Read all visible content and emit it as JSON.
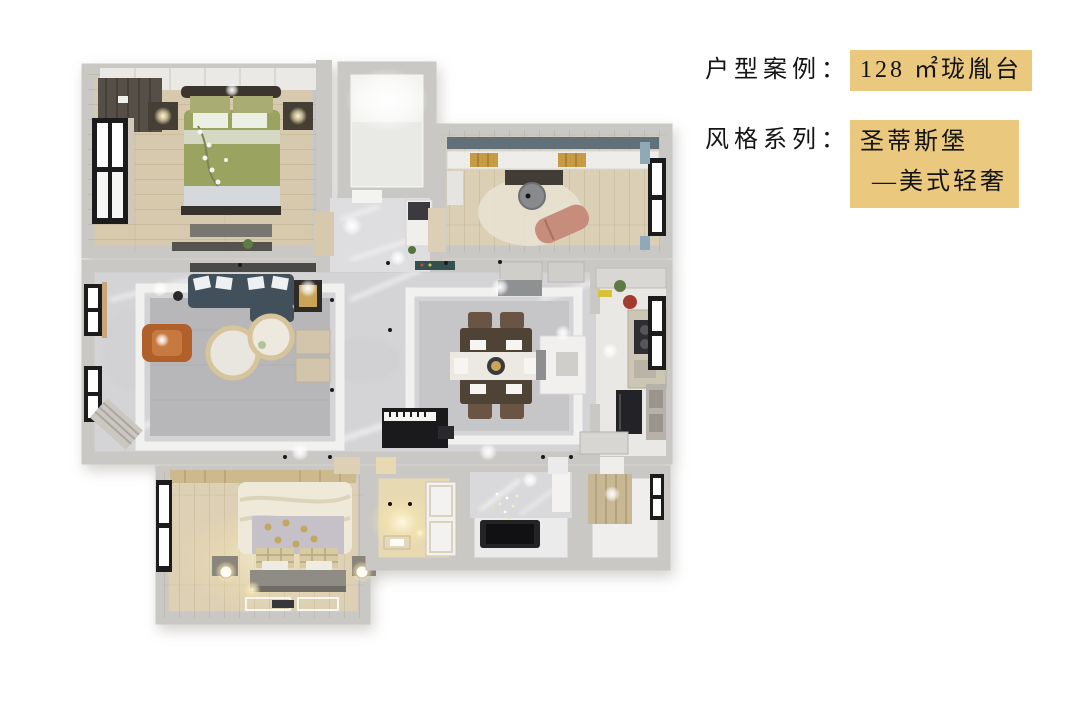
{
  "info_panel": {
    "row1": {
      "label": "户型案例：",
      "value": "128 ㎡珑胤台"
    },
    "row2": {
      "label": "风格系列：",
      "line1": "圣蒂斯堡",
      "line2": "—美式轻奢"
    },
    "highlight_color": "#eac87e",
    "text_color": "#141414"
  },
  "floor_plan": {
    "colors": {
      "wall": "#c9c8c5",
      "wood_floor": "#d7c9ad",
      "marble_floor": "#d4d4d6",
      "sofa": "#41505a",
      "armchair": "#b2602a",
      "master_duvet": "#9aa35f",
      "dining_table": "#4f4336",
      "piano": "#1a1a1c",
      "tub": "#232325",
      "rug": "#b7b7b9"
    }
  }
}
